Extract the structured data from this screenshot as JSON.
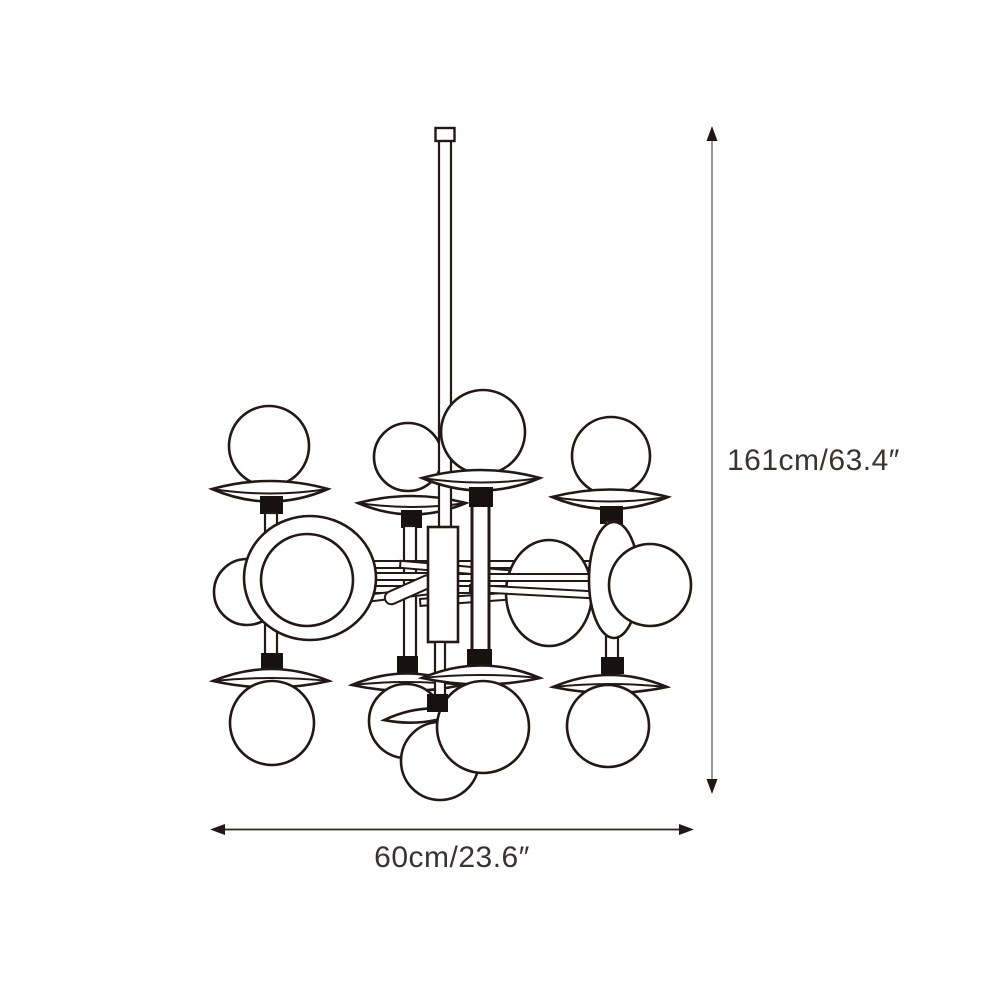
{
  "drawing": {
    "subject": "chandelier-technical-line-drawing",
    "parts": [
      "ceiling-stub",
      "hanging-stem",
      "central-hub",
      "horizontal-arms",
      "glass-globe",
      "saucer-shade",
      "lamp-socket"
    ]
  },
  "dimensions": {
    "height_label": "161cm/63.4″",
    "width_label": "60cm/23.6″"
  },
  "colors": {
    "line": "#231815",
    "socket_fill": "#171210",
    "vertical_dimension_line": "#8b8784",
    "horizontal_dimension_line": "#2b2421",
    "label_text": "#3a3331",
    "background": "#ffffff"
  }
}
